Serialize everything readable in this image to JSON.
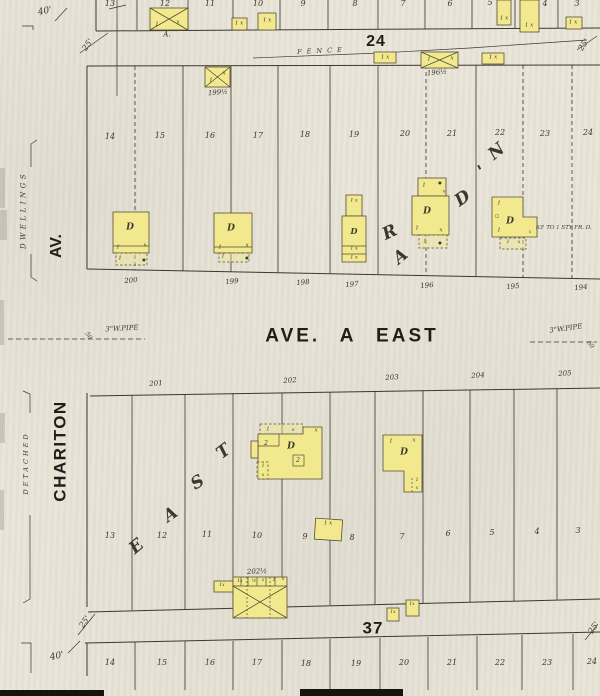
{
  "colors": {
    "paper": "#e9e5d9",
    "ink": "#3b382c",
    "yellow": "#f2e98f",
    "bar": "#15140f"
  },
  "streets": {
    "ave_a_east": "AVE. A EAST",
    "chariton": "CHARITON",
    "av": "AV."
  },
  "margin": {
    "dwellings": "DWELLINGS",
    "detached": "DETACHED"
  },
  "blocks": {
    "b24": "24",
    "b37": "37"
  },
  "annotations": {
    "fence": "FENCE",
    "pipe_left": "3\"W.PIPE",
    "pipe_right": "3\"W.PIPE",
    "note_195": "63' TO 1 STY FR. D."
  },
  "labels": {
    "lot_numbers": [
      {
        "t": "13",
        "x": 110,
        "y": 4
      },
      {
        "t": "12",
        "x": 165,
        "y": 4
      },
      {
        "t": "11",
        "x": 210,
        "y": 4
      },
      {
        "t": "10",
        "x": 258,
        "y": 4
      },
      {
        "t": "9",
        "x": 303,
        "y": 4
      },
      {
        "t": "8",
        "x": 355,
        "y": 4
      },
      {
        "t": "7",
        "x": 403,
        "y": 4
      },
      {
        "t": "6",
        "x": 450,
        "y": 4
      },
      {
        "t": "5",
        "x": 490,
        "y": 3
      },
      {
        "t": "4",
        "x": 545,
        "y": 4
      },
      {
        "t": "3",
        "x": 577,
        "y": 4
      },
      {
        "t": "14",
        "x": 110,
        "y": 137
      },
      {
        "t": "15",
        "x": 160,
        "y": 136
      },
      {
        "t": "16",
        "x": 210,
        "y": 136
      },
      {
        "t": "17",
        "x": 258,
        "y": 136
      },
      {
        "t": "18",
        "x": 305,
        "y": 135
      },
      {
        "t": "19",
        "x": 354,
        "y": 135
      },
      {
        "t": "20",
        "x": 405,
        "y": 134
      },
      {
        "t": "21",
        "x": 452,
        "y": 134
      },
      {
        "t": "22",
        "x": 500,
        "y": 133
      },
      {
        "t": "23",
        "x": 545,
        "y": 134
      },
      {
        "t": "24",
        "x": 588,
        "y": 133
      },
      {
        "t": "13",
        "x": 110,
        "y": 536
      },
      {
        "t": "12",
        "x": 162,
        "y": 536
      },
      {
        "t": "11",
        "x": 207,
        "y": 535
      },
      {
        "t": "10",
        "x": 257,
        "y": 536
      },
      {
        "t": "9",
        "x": 305,
        "y": 537
      },
      {
        "t": "8",
        "x": 352,
        "y": 538
      },
      {
        "t": "7",
        "x": 402,
        "y": 537
      },
      {
        "t": "6",
        "x": 448,
        "y": 534
      },
      {
        "t": "5",
        "x": 492,
        "y": 533
      },
      {
        "t": "4",
        "x": 537,
        "y": 532
      },
      {
        "t": "3",
        "x": 578,
        "y": 531
      },
      {
        "t": "14",
        "x": 110,
        "y": 663
      },
      {
        "t": "15",
        "x": 162,
        "y": 663
      },
      {
        "t": "16",
        "x": 210,
        "y": 663
      },
      {
        "t": "17",
        "x": 257,
        "y": 663
      },
      {
        "t": "18",
        "x": 306,
        "y": 664
      },
      {
        "t": "19",
        "x": 356,
        "y": 664
      },
      {
        "t": "20",
        "x": 404,
        "y": 663
      },
      {
        "t": "21",
        "x": 452,
        "y": 663
      },
      {
        "t": "22",
        "x": 500,
        "y": 663
      },
      {
        "t": "23",
        "x": 547,
        "y": 663
      },
      {
        "t": "24",
        "x": 592,
        "y": 662
      }
    ],
    "addresses": [
      {
        "t": "200",
        "x": 131,
        "y": 281,
        "r": -5,
        "s": 7
      },
      {
        "t": "199",
        "x": 232,
        "y": 282,
        "r": -5,
        "s": 7
      },
      {
        "t": "198",
        "x": 303,
        "y": 283,
        "r": -5,
        "s": 7
      },
      {
        "t": "197",
        "x": 352,
        "y": 285,
        "r": -5,
        "s": 7
      },
      {
        "t": "196",
        "x": 427,
        "y": 286,
        "r": -5,
        "s": 7
      },
      {
        "t": "195",
        "x": 513,
        "y": 287,
        "r": -5,
        "s": 7
      },
      {
        "t": "194",
        "x": 581,
        "y": 288,
        "r": -5,
        "s": 7
      },
      {
        "t": "201",
        "x": 156,
        "y": 384,
        "r": -4,
        "s": 7
      },
      {
        "t": "202",
        "x": 290,
        "y": 381,
        "r": -4,
        "s": 7
      },
      {
        "t": "203",
        "x": 392,
        "y": 378,
        "r": -4,
        "s": 7
      },
      {
        "t": "204",
        "x": 478,
        "y": 376,
        "r": -4,
        "s": 7
      },
      {
        "t": "205",
        "x": 565,
        "y": 374,
        "r": -4,
        "s": 7
      }
    ],
    "building_addresses": [
      {
        "t": "A.",
        "x": 167,
        "y": 35,
        "s": 7
      },
      {
        "t": "199½",
        "x": 218,
        "y": 93,
        "r": -5,
        "s": 7
      },
      {
        "t": "196½",
        "x": 437,
        "y": 73,
        "r": -5,
        "s": 7
      },
      {
        "t": "202½",
        "x": 257,
        "y": 572,
        "r": -3,
        "s": 7
      }
    ],
    "dimensions": [
      {
        "t": "40'",
        "x": 45,
        "y": 12,
        "r": -12,
        "s": 9
      },
      {
        "t": "40'",
        "x": 57,
        "y": 657,
        "r": -12,
        "s": 9
      },
      {
        "t": "25'",
        "x": 88,
        "y": 45,
        "r": -55,
        "s": 8
      },
      {
        "t": "25'",
        "x": 584,
        "y": 45,
        "r": -55,
        "s": 8
      },
      {
        "t": "25'",
        "x": 85,
        "y": 622,
        "r": -55,
        "s": 8
      },
      {
        "t": "25'",
        "x": 594,
        "y": 628,
        "r": -55,
        "s": 8
      },
      {
        "t": "50",
        "x": 88,
        "y": 336,
        "r": 55,
        "s": 6
      },
      {
        "t": "60",
        "x": 590,
        "y": 345,
        "r": 55,
        "s": 6
      }
    ],
    "script_letters": [
      {
        "t": "R",
        "x": 390,
        "y": 233,
        "r": -25,
        "s": 17,
        "f": "s"
      },
      {
        "t": "A",
        "x": 401,
        "y": 257,
        "r": -40,
        "s": 17,
        "f": "s"
      },
      {
        "t": "D",
        "x": 463,
        "y": 199,
        "r": -35,
        "s": 17,
        "f": "s"
      },
      {
        "t": "'",
        "x": 482,
        "y": 172,
        "r": -30,
        "s": 17,
        "f": "s"
      },
      {
        "t": "N",
        "x": 497,
        "y": 152,
        "r": -40,
        "s": 17,
        "f": "s"
      },
      {
        "t": "E",
        "x": 137,
        "y": 547,
        "r": -40,
        "s": 17,
        "f": "s"
      },
      {
        "t": "A",
        "x": 171,
        "y": 515,
        "r": -35,
        "s": 17,
        "f": "s"
      },
      {
        "t": "S",
        "x": 198,
        "y": 483,
        "r": -32,
        "s": 17,
        "f": "s"
      },
      {
        "t": "T",
        "x": 224,
        "y": 452,
        "r": -38,
        "s": 17,
        "f": "s"
      }
    ],
    "building_marks": [
      {
        "t": "1",
        "x": 157,
        "y": 25
      },
      {
        "t": "x",
        "x": 178,
        "y": 23
      },
      {
        "t": "1 x",
        "x": 239,
        "y": 24
      },
      {
        "t": "1 x",
        "x": 267,
        "y": 21
      },
      {
        "t": "1 x",
        "x": 504,
        "y": 19
      },
      {
        "t": "1 x",
        "x": 529,
        "y": 26
      },
      {
        "t": "1 x",
        "x": 573,
        "y": 23
      },
      {
        "t": "1 x",
        "x": 385,
        "y": 58
      },
      {
        "t": "1",
        "x": 429,
        "y": 60
      },
      {
        "t": "x",
        "x": 452,
        "y": 59
      },
      {
        "t": "1 x",
        "x": 493,
        "y": 58
      },
      {
        "t": "1",
        "x": 211,
        "y": 81
      },
      {
        "t": "x",
        "x": 224,
        "y": 74
      },
      {
        "t": "D",
        "x": 130,
        "y": 228,
        "f": "s",
        "s": 9
      },
      {
        "t": "1",
        "x": 118,
        "y": 248
      },
      {
        "t": "x",
        "x": 145,
        "y": 246
      },
      {
        "t": "1",
        "x": 120,
        "y": 259
      },
      {
        "t": "●",
        "x": 144,
        "y": 260,
        "s": 4
      },
      {
        "t": "D",
        "x": 231,
        "y": 229,
        "f": "s",
        "s": 9
      },
      {
        "t": "1",
        "x": 220,
        "y": 248
      },
      {
        "t": "x",
        "x": 247,
        "y": 246
      },
      {
        "t": "1",
        "x": 223,
        "y": 257
      },
      {
        "t": "●",
        "x": 247,
        "y": 258,
        "s": 4
      },
      {
        "t": "1 x",
        "x": 354,
        "y": 201,
        "s": 5
      },
      {
        "t": "D",
        "x": 354,
        "y": 231,
        "f": "s",
        "s": 8
      },
      {
        "t": "1 x",
        "x": 354,
        "y": 249,
        "s": 5
      },
      {
        "t": "1 x",
        "x": 354,
        "y": 258,
        "s": 5
      },
      {
        "t": "1",
        "x": 424,
        "y": 186
      },
      {
        "t": "●",
        "x": 440,
        "y": 183,
        "s": 4
      },
      {
        "t": "x",
        "x": 444,
        "y": 192,
        "s": 5
      },
      {
        "t": "D",
        "x": 427,
        "y": 212,
        "f": "s",
        "s": 9
      },
      {
        "t": "1",
        "x": 417,
        "y": 229
      },
      {
        "t": "x",
        "x": 441,
        "y": 231
      },
      {
        "t": "1",
        "x": 425,
        "y": 242
      },
      {
        "t": "●",
        "x": 440,
        "y": 243,
        "s": 4
      },
      {
        "t": "1",
        "x": 499,
        "y": 204
      },
      {
        "t": "○",
        "x": 497,
        "y": 217,
        "s": 5
      },
      {
        "t": "D",
        "x": 510,
        "y": 222,
        "f": "s",
        "s": 9
      },
      {
        "t": "1",
        "x": 499,
        "y": 231
      },
      {
        "t": "x",
        "x": 530,
        "y": 233,
        "s": 4.5
      },
      {
        "t": "1",
        "x": 508,
        "y": 243,
        "s": 4.5
      },
      {
        "t": "x",
        "x": 519,
        "y": 243,
        "s": 4.5
      },
      {
        "t": "1",
        "x": 268,
        "y": 430
      },
      {
        "t": "o",
        "x": 293,
        "y": 431,
        "s": 4.5
      },
      {
        "t": "x",
        "x": 316,
        "y": 431
      },
      {
        "t": "2",
        "x": 266,
        "y": 444,
        "s": 6
      },
      {
        "t": "D",
        "x": 291,
        "y": 447,
        "f": "s",
        "s": 9
      },
      {
        "t": "2",
        "x": 298,
        "y": 461,
        "s": 6
      },
      {
        "t": "1",
        "x": 263,
        "y": 467,
        "s": 4.5
      },
      {
        "t": "x",
        "x": 263,
        "y": 476,
        "s": 4.5
      },
      {
        "t": "1",
        "x": 391,
        "y": 442
      },
      {
        "t": "x",
        "x": 414,
        "y": 441
      },
      {
        "t": "D",
        "x": 404,
        "y": 453,
        "f": "s",
        "s": 9
      },
      {
        "t": "1",
        "x": 417,
        "y": 481,
        "s": 4.5
      },
      {
        "t": "x",
        "x": 417,
        "y": 489,
        "s": 4.5
      },
      {
        "t": "1 x",
        "x": 328,
        "y": 524
      },
      {
        "t": "1x",
        "x": 222,
        "y": 586,
        "s": 4.5
      },
      {
        "t": "1x",
        "x": 240,
        "y": 582,
        "s": 4.5
      },
      {
        "t": "½",
        "x": 254,
        "y": 582,
        "s": 4.5
      },
      {
        "t": "x",
        "x": 263,
        "y": 581,
        "s": 4.5
      },
      {
        "t": "1",
        "x": 274,
        "y": 581,
        "s": 4.5
      },
      {
        "t": "x",
        "x": 283,
        "y": 580,
        "s": 4.5
      },
      {
        "t": "1x",
        "x": 393,
        "y": 613,
        "s": 4.5
      },
      {
        "t": "1x",
        "x": 412,
        "y": 605,
        "s": 4.5
      }
    ]
  }
}
